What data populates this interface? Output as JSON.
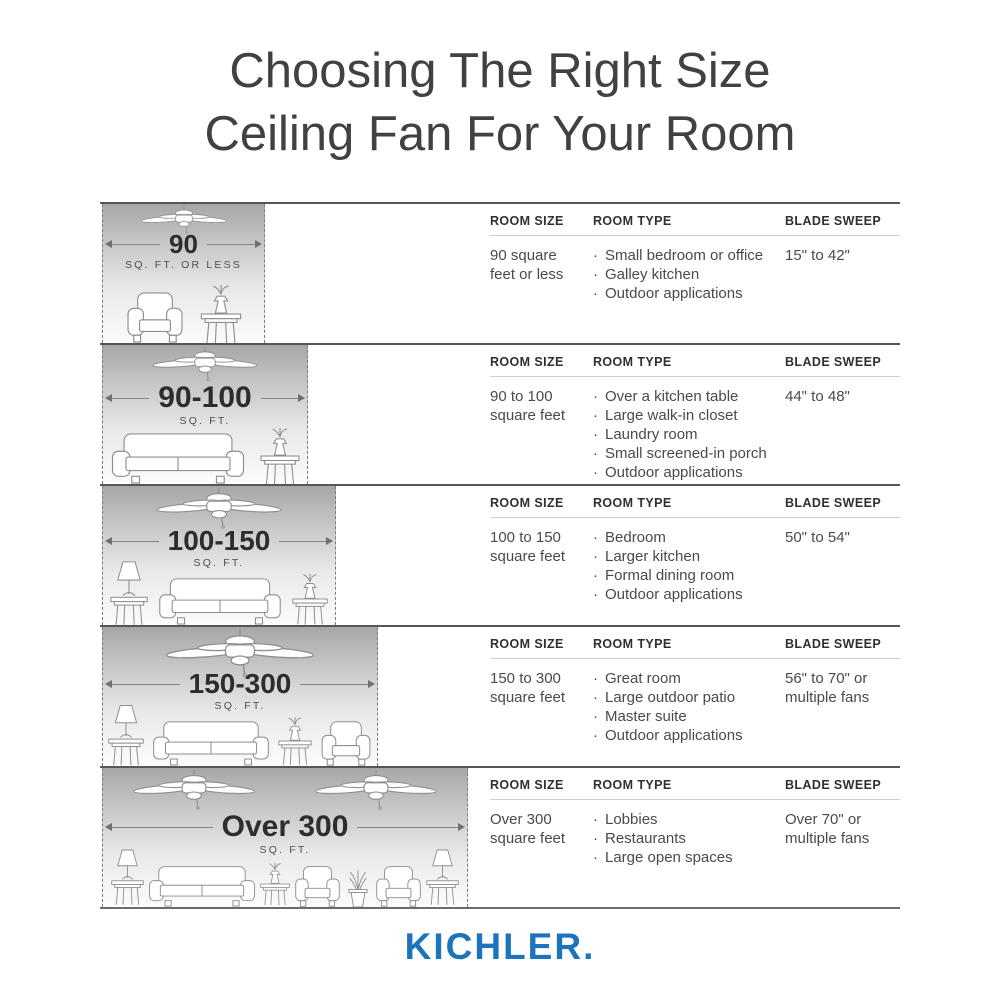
{
  "title": {
    "line1": "Choosing The Right Size",
    "line2": "Ceiling Fan For Your Room"
  },
  "columns": {
    "room_size": "ROOM SIZE",
    "room_type": "ROOM TYPE",
    "blade_sweep": "BLADE SWEEP"
  },
  "rows": [
    {
      "size_label": "90",
      "size_unit": "SQ. FT. OR LESS",
      "room_size": "90 square feet or less",
      "room_types": [
        "Small bedroom or office",
        "Galley kitchen",
        "Outdoor applications"
      ],
      "blade_sweep": "15\" to 42\"",
      "icons": [
        "ceiling-fan-icon",
        "armchair-icon",
        "side-table-icon"
      ]
    },
    {
      "size_label": "90-100",
      "size_unit": "SQ. FT.",
      "room_size": "90 to 100 square feet",
      "room_types": [
        "Over a kitchen table",
        "Large walk-in closet",
        "Laundry room",
        "Small screened-in porch",
        "Outdoor applications"
      ],
      "blade_sweep": "44\" to 48\"",
      "icons": [
        "ceiling-fan-icon",
        "sofa-icon",
        "side-table-icon"
      ]
    },
    {
      "size_label": "100-150",
      "size_unit": "SQ. FT.",
      "room_size": "100 to 150 square feet",
      "room_types": [
        "Bedroom",
        "Larger kitchen",
        "Formal dining room",
        "Outdoor applications"
      ],
      "blade_sweep": "50\" to 54\"",
      "icons": [
        "ceiling-fan-icon",
        "lamp-table-icon",
        "sofa-icon",
        "side-table-icon"
      ]
    },
    {
      "size_label": "150-300",
      "size_unit": "SQ. FT.",
      "room_size": "150 to 300 square feet",
      "room_types": [
        "Great room",
        "Large outdoor patio",
        "Master suite",
        "Outdoor applications"
      ],
      "blade_sweep": "56\" to 70\" or multiple fans",
      "icons": [
        "ceiling-fan-icon",
        "lamp-table-icon",
        "sofa-icon",
        "side-table-icon",
        "armchair-icon"
      ]
    },
    {
      "size_label": "Over 300",
      "size_unit": "SQ. FT.",
      "room_size": "Over 300 square feet",
      "room_types": [
        "Lobbies",
        "Restaurants",
        "Large open spaces"
      ],
      "blade_sweep": "Over 70\" or multiple fans",
      "icons": [
        "ceiling-fan-icon",
        "ceiling-fan-icon",
        "lamp-table-icon",
        "sofa-icon",
        "side-table-icon",
        "armchair-icon",
        "potted-plant-icon",
        "armchair-icon",
        "lamp-table-icon"
      ]
    }
  ],
  "brand": {
    "name": "KICHLER."
  },
  "colors": {
    "brand_blue": "#1c75bc",
    "divider": "#565656",
    "gradient_top": "#a7a7a7",
    "text": "#4a4a4a"
  }
}
